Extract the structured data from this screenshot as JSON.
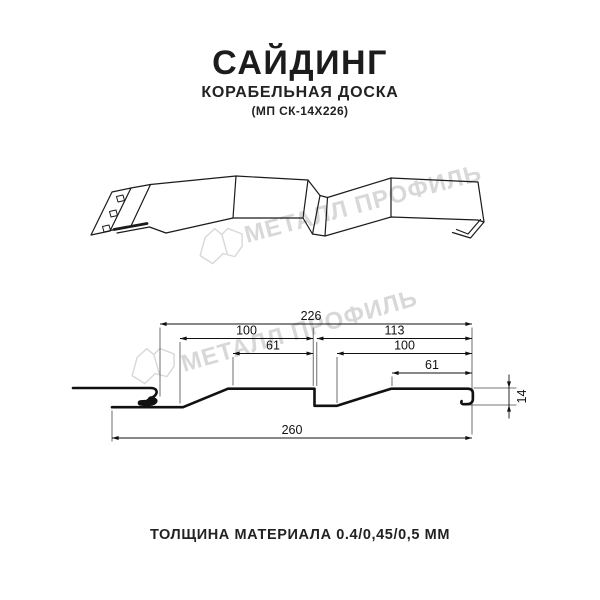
{
  "header": {
    "title": "САЙДИНГ",
    "subtitle": "КОРАБЕЛЬНАЯ ДОСКА",
    "code": "(МП СК-14Х226)"
  },
  "watermark": {
    "text": "МЕТАЛЛ ПРОФИЛЬ",
    "color": "#d8d8d8"
  },
  "cross_section": {
    "units": "mm",
    "dims": {
      "overall_top": "226",
      "left_board": "100",
      "right_board": "113",
      "left_flat": "61",
      "right_flat": "100",
      "right_inner_flat": "61",
      "overall_bottom": "260",
      "profile_height": "14"
    }
  },
  "footer": {
    "text": "ТОЛЩИНА МАТЕРИАЛА 0.4/0,45/0,5 ММ"
  }
}
